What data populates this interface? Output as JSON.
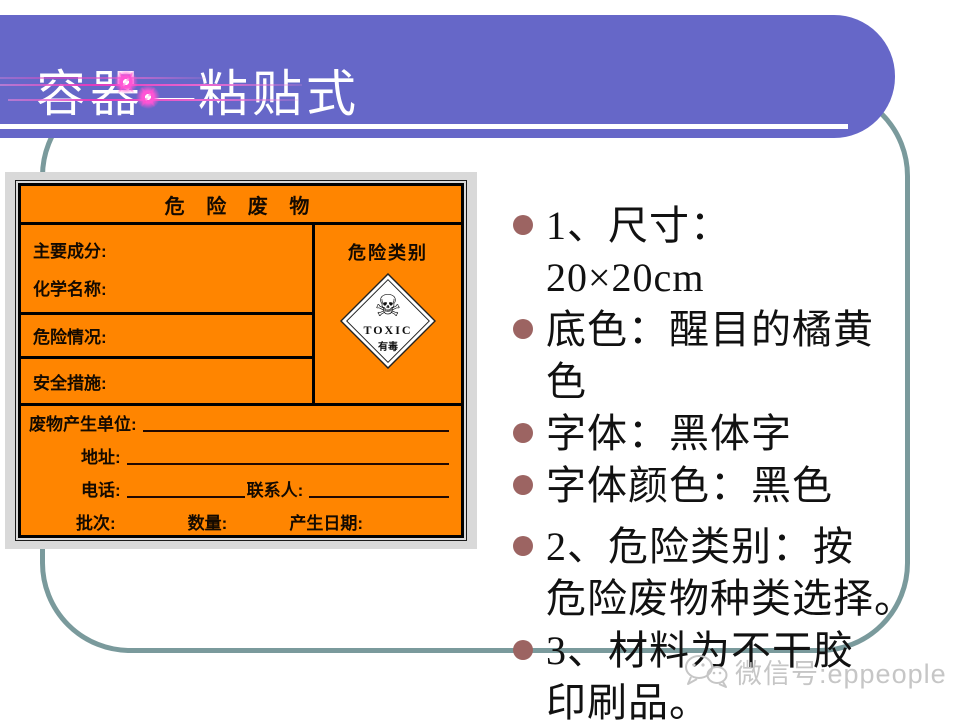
{
  "slide": {
    "title": "容器—粘贴式",
    "bullets": [
      {
        "text": "1、尺寸：\n20×20cm"
      },
      {
        "text": "底色：醒目的橘黄\n色"
      },
      {
        "text": "字体：黑体字"
      },
      {
        "text": "字体颜色：黑色"
      },
      {
        "text": "2、危险类别：按\n危险废物种类选择。"
      },
      {
        "text": "3、材料为不干胶\n印刷品。"
      }
    ],
    "watermark_text": "微信号:eppeople"
  },
  "hazard_label": {
    "title": "危 险 废 物",
    "main_component": "主要成分:",
    "chemical_name": "化学名称:",
    "hazard_situation": "危险情况:",
    "safety_measures": "安全措施:",
    "hazard_category": "危险类别",
    "waste_producer": "废物产生单位:",
    "address": "地址:",
    "phone": "电话:",
    "contact": "联系人:",
    "batch": "批次:",
    "quantity": "数量:",
    "production_date": "产生日期:",
    "toxic": {
      "symbol": "☠",
      "en": "TOXIC",
      "zh": "有毒"
    }
  },
  "colors": {
    "band_purple": "#6667C8",
    "frame_teal": "#7A9A9C",
    "label_orange": "#FF8500",
    "bullet_maroon": "#9C6462",
    "sparkle_pink": "#E23BBD",
    "watermark_gray": "#C6C6C6"
  }
}
